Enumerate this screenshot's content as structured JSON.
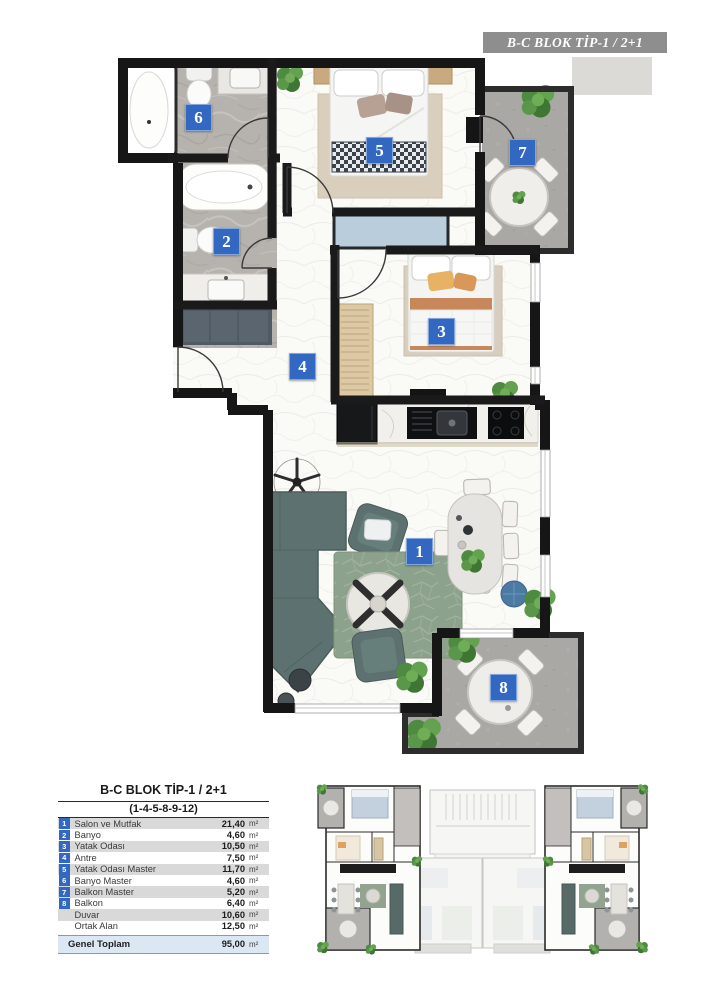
{
  "plan": {
    "title": "B-C BLOK TİP-1 / 2+1",
    "title_bg": "#8e8e8e",
    "badge_color": "#3268c2",
    "wall_color": "#161616",
    "badges": [
      {
        "num": "1"
      },
      {
        "num": "2"
      },
      {
        "num": "3"
      },
      {
        "num": "4"
      },
      {
        "num": "5"
      },
      {
        "num": "6"
      },
      {
        "num": "7"
      },
      {
        "num": "8"
      }
    ]
  },
  "legend": {
    "header": "B-C BLOK TİP-1 / 2+1",
    "subheader": "(1-4-5-8-9-12)",
    "rows": [
      {
        "num": "1",
        "label": "Salon ve Mutfak",
        "value": "21,40",
        "unit": "m²"
      },
      {
        "num": "2",
        "label": "Banyo",
        "value": "4,60",
        "unit": "m²"
      },
      {
        "num": "3",
        "label": "Yatak Odası",
        "value": "10,50",
        "unit": "m²"
      },
      {
        "num": "4",
        "label": "Antre",
        "value": "7,50",
        "unit": "m²"
      },
      {
        "num": "5",
        "label": "Yatak Odası Master",
        "value": "11,70",
        "unit": "m²"
      },
      {
        "num": "6",
        "label": "Banyo Master",
        "value": "4,60",
        "unit": "m²"
      },
      {
        "num": "7",
        "label": "Balkon Master",
        "value": "5,20",
        "unit": "m²"
      },
      {
        "num": "8",
        "label": "Balkon",
        "value": "6,40",
        "unit": "m²"
      },
      {
        "num": "",
        "label": "Duvar",
        "value": "10,60",
        "unit": "m²"
      },
      {
        "num": "",
        "label": "Ortak Alan",
        "value": "12,50",
        "unit": "m²"
      }
    ],
    "total": {
      "label": "Genel Toplam",
      "value": "95,00",
      "unit": "m²"
    }
  }
}
